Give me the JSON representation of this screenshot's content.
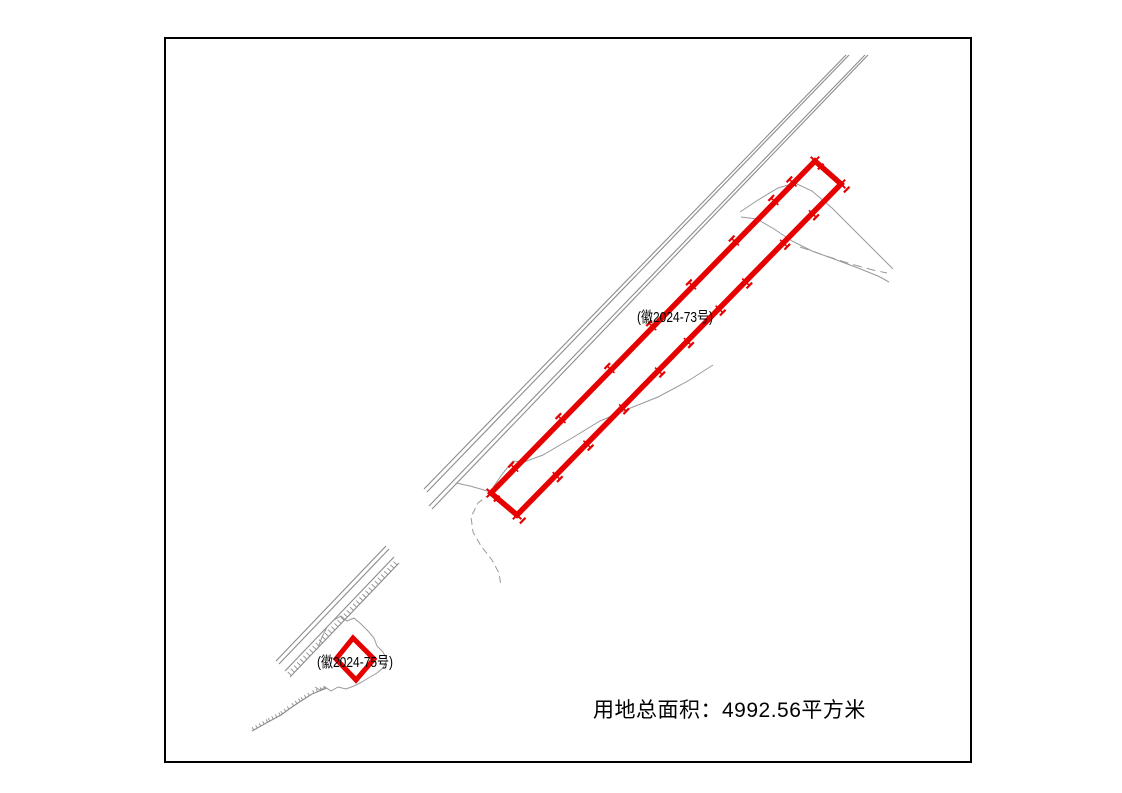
{
  "page": {
    "width": 1122,
    "height": 793,
    "background": "#ffffff"
  },
  "frame": {
    "x": 164,
    "y": 37,
    "width": 808,
    "height": 726,
    "border_color": "#000000",
    "border_width": 2
  },
  "labels": {
    "main_parcel": {
      "text": "(徽2024-73号)",
      "x": 637,
      "y": 306,
      "font_size": 15
    },
    "small_parcel": {
      "text": "(徽2024-75号)",
      "x": 317,
      "y": 651,
      "font_size": 15
    },
    "total_area": {
      "text": "用地总面积：4992.56平方米",
      "x": 593,
      "y": 694,
      "font_size": 21
    }
  },
  "colors": {
    "parcel_red": "#e60000",
    "road_gray": "#8c8c8c",
    "contour_gray": "#999999",
    "text_black": "#000000"
  },
  "geometry": {
    "roads": [
      {
        "name": "ne-road-1",
        "pts": [
          [
            846,
            55
          ],
          [
            424,
            489
          ]
        ]
      },
      {
        "name": "ne-road-2",
        "pts": [
          [
            849,
            55
          ],
          [
            427,
            492
          ]
        ]
      },
      {
        "name": "ne-road-3",
        "pts": [
          [
            865,
            55
          ],
          [
            429,
            506
          ]
        ]
      },
      {
        "name": "ne-road-4",
        "pts": [
          [
            868,
            55
          ],
          [
            432,
            509
          ]
        ]
      },
      {
        "name": "sw-road-1",
        "pts": [
          [
            276,
            661
          ],
          [
            386,
            546
          ]
        ]
      },
      {
        "name": "sw-road-2",
        "pts": [
          [
            279,
            664
          ],
          [
            389,
            549
          ]
        ]
      },
      {
        "name": "sw-road-3",
        "pts": [
          [
            285,
            671
          ],
          [
            394,
            557
          ]
        ]
      }
    ],
    "combs": [
      {
        "name": "sw-embankment-hatch",
        "pts": [
          [
            290,
            677
          ],
          [
            399,
            563
          ]
        ],
        "tick": 5,
        "gap": 4.5
      },
      {
        "name": "sw-embankment-hatch-2",
        "pts": [
          [
            252,
            731
          ],
          [
            268,
            722
          ],
          [
            281,
            715
          ],
          [
            292,
            707
          ],
          [
            301,
            701
          ],
          [
            312,
            694
          ],
          [
            327,
            688
          ]
        ],
        "tick": 3.2,
        "gap": 4
      }
    ],
    "contours": [
      {
        "name": "hill-curve-1",
        "pts": [
          [
            740,
            212
          ],
          [
            758,
            200
          ],
          [
            778,
            188
          ],
          [
            795,
            183
          ],
          [
            812,
            191
          ],
          [
            832,
            208
          ],
          [
            852,
            228
          ],
          [
            872,
            248
          ],
          [
            893,
            269
          ]
        ]
      },
      {
        "name": "hill-curve-2",
        "pts": [
          [
            741,
            217
          ],
          [
            757,
            219
          ],
          [
            774,
            229
          ],
          [
            792,
            241
          ],
          [
            812,
            251
          ],
          [
            834,
            259
          ],
          [
            858,
            268
          ],
          [
            878,
            276
          ],
          [
            889,
            282
          ]
        ]
      },
      {
        "name": "hill-curve-dashed",
        "pts": [
          [
            800,
            247
          ],
          [
            826,
            256
          ],
          [
            851,
            264
          ],
          [
            873,
            270
          ],
          [
            887,
            273
          ]
        ],
        "dash": "9 5"
      },
      {
        "name": "long-contour",
        "pts": [
          [
            713,
            365
          ],
          [
            688,
            381
          ],
          [
            658,
            397
          ],
          [
            628,
            409
          ],
          [
            600,
            421
          ],
          [
            572,
            438
          ],
          [
            543,
            455
          ],
          [
            524,
            462
          ],
          [
            513,
            461
          ],
          [
            503,
            473
          ],
          [
            494,
            486
          ],
          [
            491,
            493
          ]
        ]
      },
      {
        "name": "contour-trail-dashed",
        "pts": [
          [
            491,
            493
          ],
          [
            478,
            503
          ],
          [
            471,
            517
          ],
          [
            473,
            532
          ],
          [
            481,
            546
          ],
          [
            492,
            560
          ],
          [
            499,
            573
          ],
          [
            501,
            586
          ]
        ],
        "dash": "7 4"
      },
      {
        "name": "contour-spur",
        "pts": [
          [
            491,
            492
          ],
          [
            470,
            486
          ],
          [
            456,
            483
          ]
        ]
      },
      {
        "name": "pond-outline",
        "pts": [
          [
            318,
            648
          ],
          [
            322,
            637
          ],
          [
            327,
            627
          ],
          [
            334,
            620
          ],
          [
            341,
            616
          ],
          [
            347,
            621
          ],
          [
            354,
            618
          ],
          [
            361,
            624
          ],
          [
            368,
            631
          ],
          [
            374,
            638
          ],
          [
            377,
            646
          ],
          [
            383,
            652
          ],
          [
            387,
            660
          ],
          [
            383,
            668
          ],
          [
            377,
            673
          ],
          [
            370,
            677
          ],
          [
            362,
            682
          ],
          [
            354,
            686
          ],
          [
            346,
            689
          ],
          [
            338,
            687
          ],
          [
            331,
            691
          ],
          [
            325,
            687
          ],
          [
            320,
            690
          ],
          [
            315,
            687
          ]
        ]
      }
    ],
    "parcels": [
      {
        "name": "main-parcel",
        "pts": [
          [
            815,
            161
          ],
          [
            841,
            184
          ],
          [
            517,
            515
          ],
          [
            491,
            493
          ]
        ],
        "stroke_width": 5.5,
        "corner_markers": true,
        "marker_edges": [
          {
            "from": 0,
            "to": 3,
            "t": [
              0.067,
              0.123,
              0.245,
              0.377,
              0.5,
              0.629,
              0.78,
              0.926
            ],
            "out": -1
          },
          {
            "from": 1,
            "to": 2,
            "t": [
              0.089,
              0.178,
              0.295,
              0.377,
              0.475,
              0.564,
              0.675,
              0.785,
              0.88
            ],
            "out": 1
          }
        ]
      },
      {
        "name": "small-parcel",
        "pts": [
          [
            353,
            638
          ],
          [
            374,
            659
          ],
          [
            356,
            680
          ],
          [
            336,
            659
          ]
        ],
        "stroke_width": 5,
        "corner_markers": false,
        "marker_edges": []
      }
    ]
  }
}
